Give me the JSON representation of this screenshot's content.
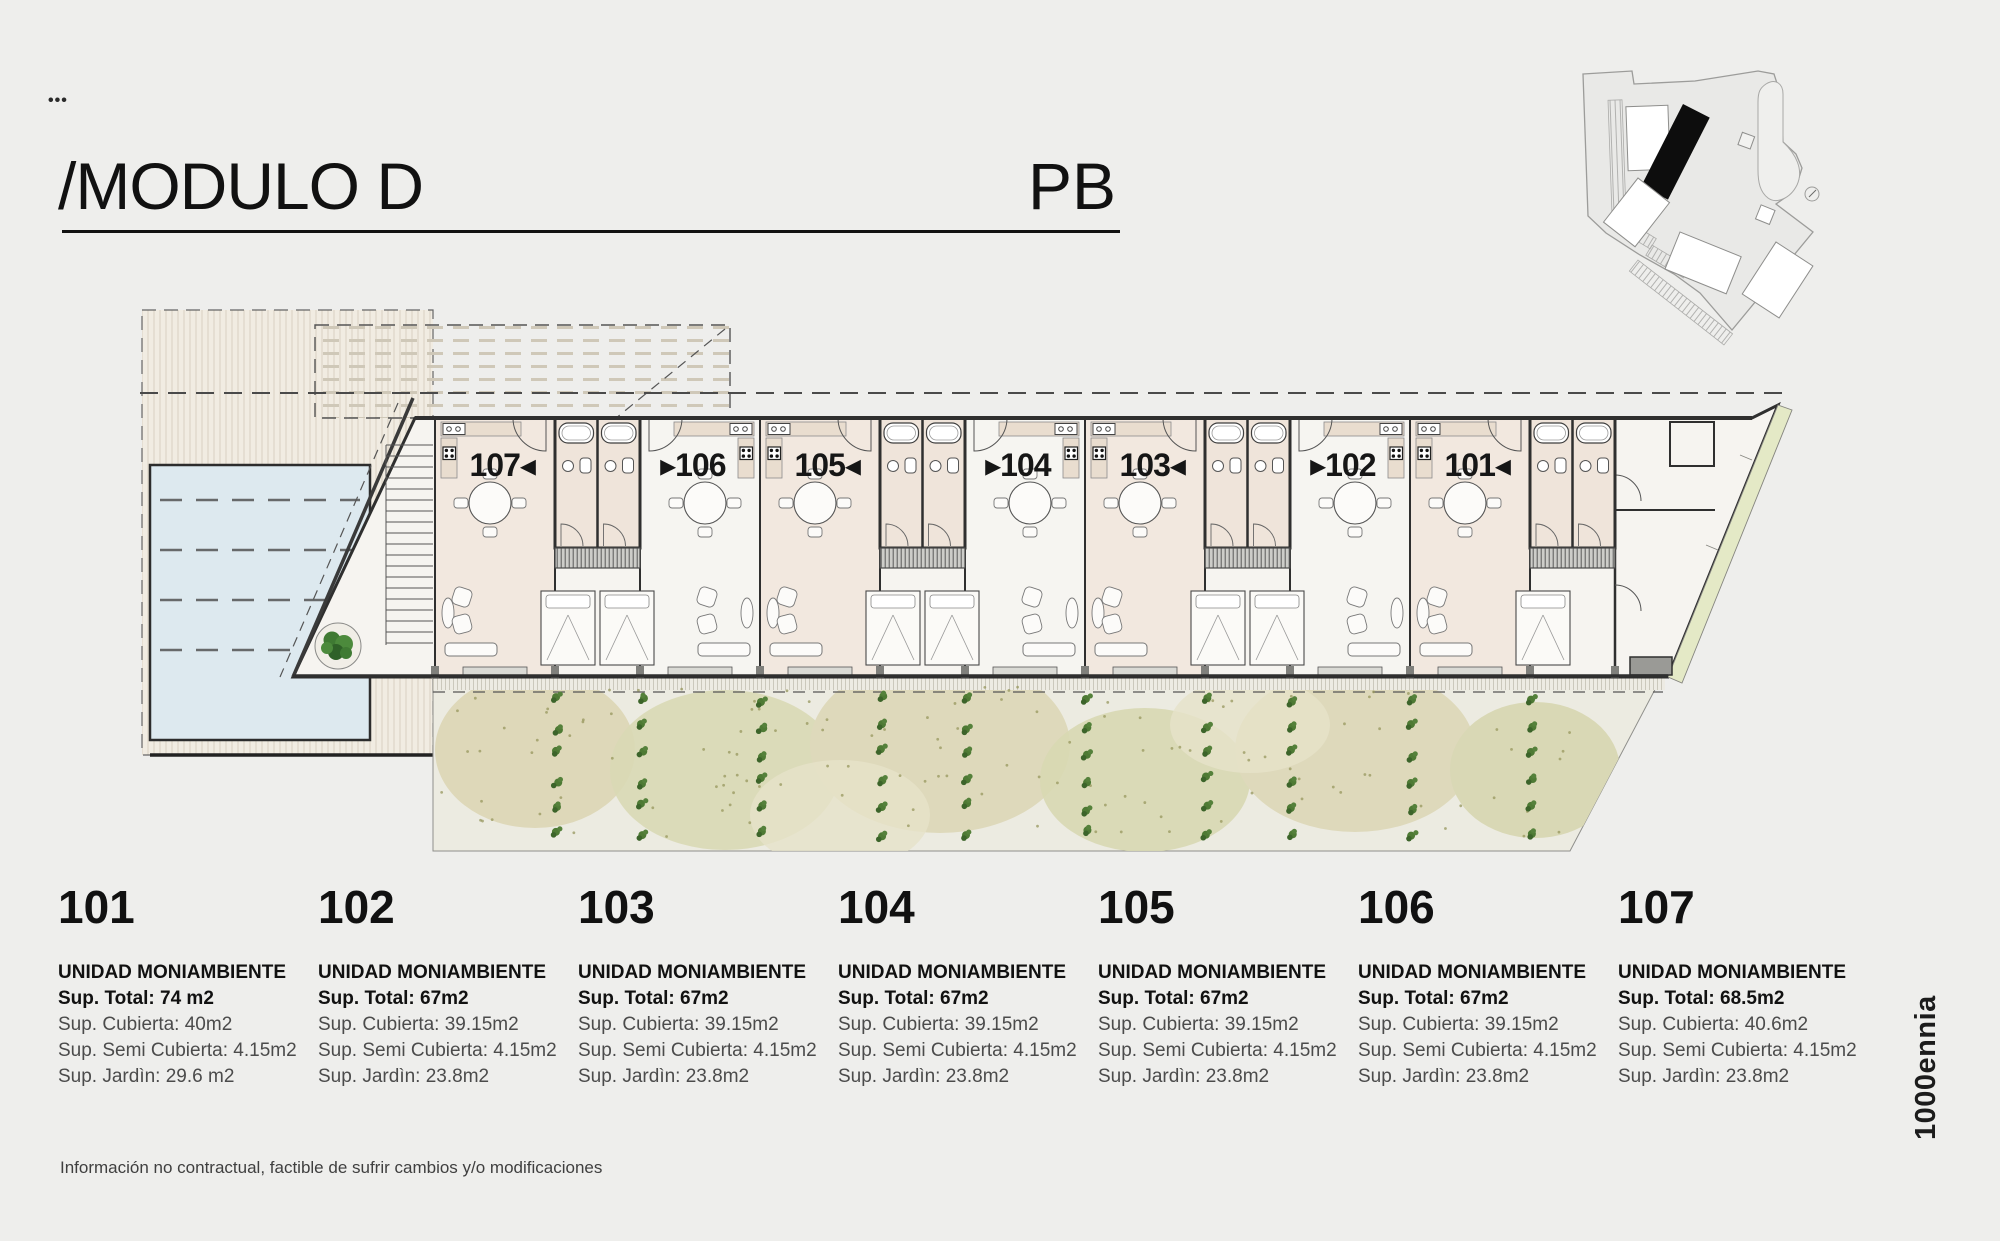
{
  "header": {
    "dots": "•••",
    "title": "/MODULO D",
    "floor_label": "PB"
  },
  "plan": {
    "units": [
      {
        "number": "107",
        "label": "107◂",
        "arrow": "left"
      },
      {
        "number": "106",
        "label": "▸106",
        "arrow": "right"
      },
      {
        "number": "105",
        "label": "105◂",
        "arrow": "left"
      },
      {
        "number": "104",
        "label": "▸104",
        "arrow": "right"
      },
      {
        "number": "103",
        "label": "103◂",
        "arrow": "left"
      },
      {
        "number": "102",
        "label": "▸102",
        "arrow": "right"
      },
      {
        "number": "101",
        "label": "101◂",
        "arrow": "left"
      }
    ],
    "colors": {
      "unit_floor_beige": "#f2e8df",
      "unit_floor_light": "#f6f5f1",
      "bathroom_floor": "#efe4da",
      "garden_olive": "#dcd6b6",
      "pool_blue": "#dde9ef",
      "wall": "#2f2f2f",
      "highlight_black": "#111111"
    }
  },
  "footer": {
    "units": [
      {
        "number": "101",
        "type": "UNIDAD MONIAMBIENTE",
        "total": "Sup. Total: 74 m2",
        "cubierta": "Sup. Cubierta: 40m2",
        "semi": "Sup. Semi Cubierta: 4.15m2",
        "jardin": "Sup. Jardìn: 29.6 m2"
      },
      {
        "number": "102",
        "type": "UNIDAD MONIAMBIENTE",
        "total": "Sup. Total: 67m2",
        "cubierta": "Sup. Cubierta: 39.15m2",
        "semi": "Sup. Semi Cubierta: 4.15m2",
        "jardin": "Sup. Jardìn: 23.8m2"
      },
      {
        "number": "103",
        "type": "UNIDAD MONIAMBIENTE",
        "total": "Sup. Total: 67m2",
        "cubierta": "Sup. Cubierta: 39.15m2",
        "semi": "Sup. Semi Cubierta: 4.15m2",
        "jardin": "Sup. Jardìn: 23.8m2"
      },
      {
        "number": "104",
        "type": "UNIDAD MONIAMBIENTE",
        "total": "Sup. Total: 67m2",
        "cubierta": "Sup. Cubierta: 39.15m2",
        "semi": "Sup. Semi Cubierta: 4.15m2",
        "jardin": "Sup. Jardìn: 23.8m2"
      },
      {
        "number": "105",
        "type": "UNIDAD MONIAMBIENTE",
        "total": "Sup. Total: 67m2",
        "cubierta": "Sup. Cubierta: 39.15m2",
        "semi": "Sup. Semi Cubierta: 4.15m2",
        "jardin": "Sup. Jardìn: 23.8m2"
      },
      {
        "number": "106",
        "type": "UNIDAD MONIAMBIENTE",
        "total": "Sup. Total: 67m2",
        "cubierta": "Sup. Cubierta: 39.15m2",
        "semi": "Sup. Semi Cubierta: 4.15m2",
        "jardin": "Sup. Jardìn: 23.8m2"
      },
      {
        "number": "107",
        "type": "UNIDAD MONIAMBIENTE",
        "total": "Sup. Total: 68.5m2",
        "cubierta": "Sup. Cubierta: 40.6m2",
        "semi": "Sup. Semi Cubierta: 4.15m2",
        "jardin": "Sup. Jardìn: 23.8m2"
      }
    ]
  },
  "disclaimer": "Información no contractual, factible de sufrir cambios y/o modificaciones",
  "brand": "1000ennia"
}
